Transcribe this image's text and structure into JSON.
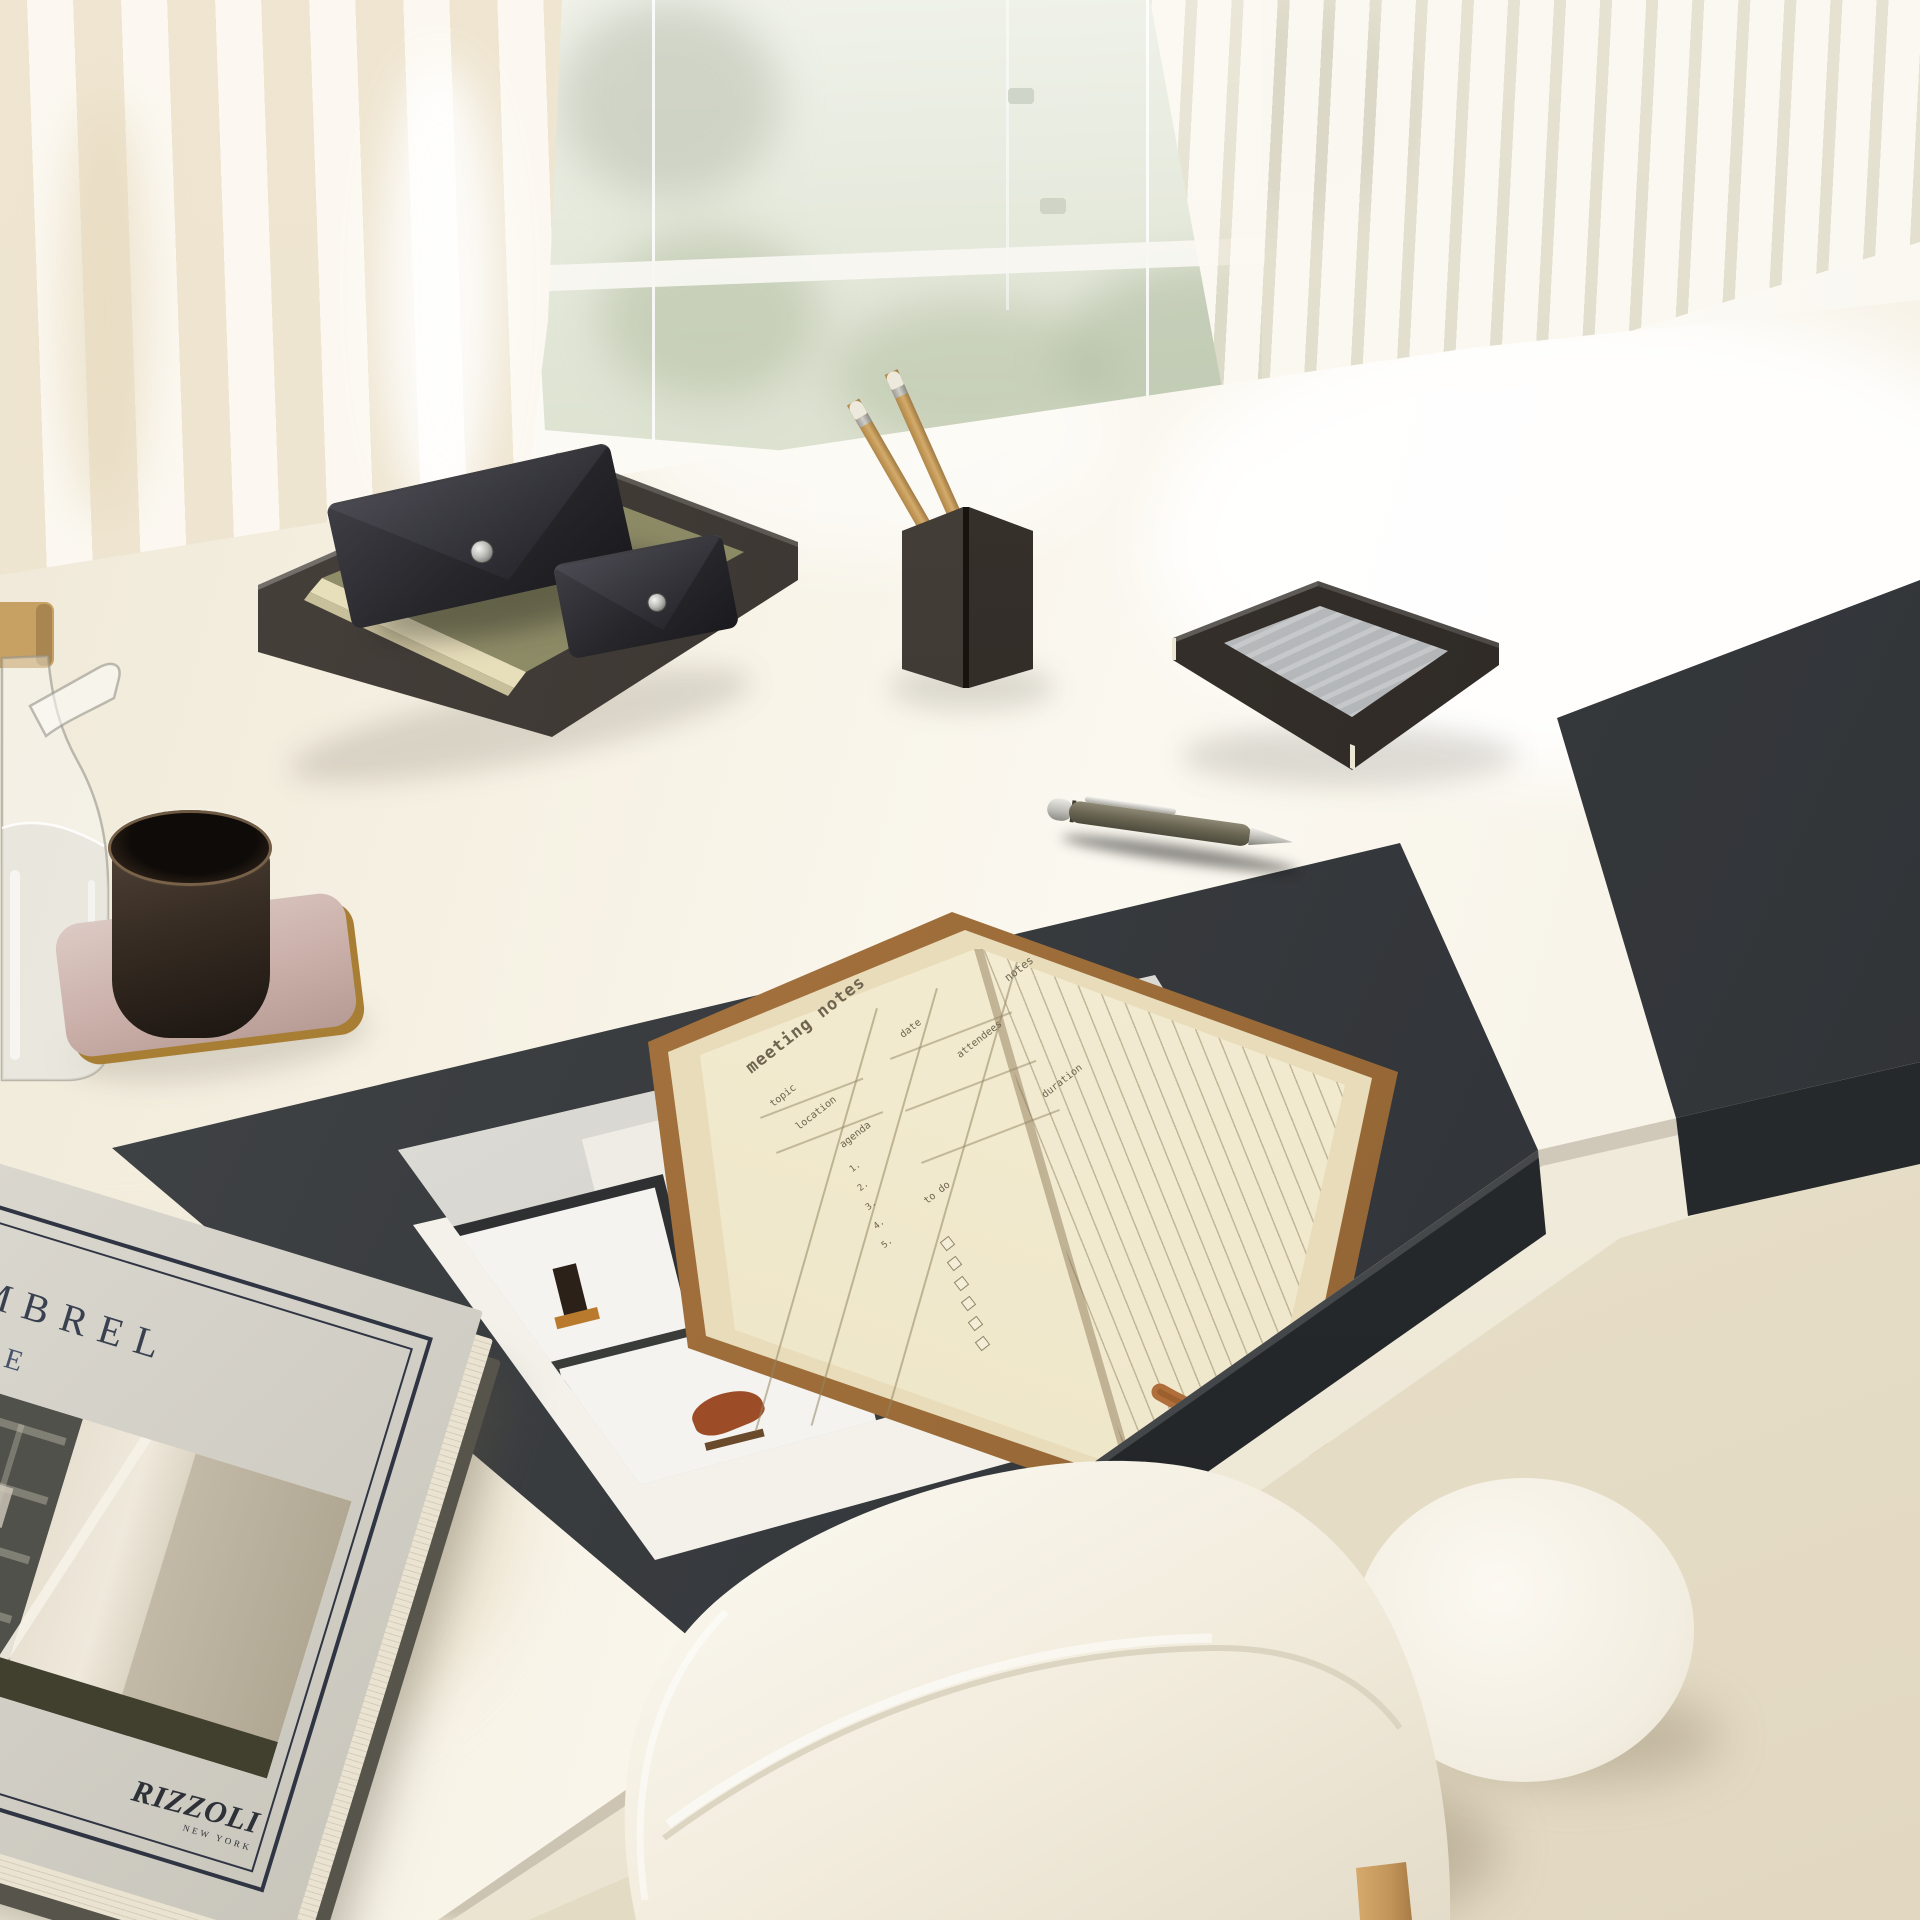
{
  "scene": {
    "setting": "bright minimalist home-office desk in front of a glass wall with sheer curtain and vertical blinds",
    "objects": [
      "sheer curtain",
      "glass wall with garden view",
      "vertical blinds",
      "white gloss desk",
      "charcoal leather desk pad",
      "charcoal accessory mat",
      "metal letter tray",
      "two leather snap pouches",
      "olive notebook in tray",
      "folded-metal pencil cup",
      "wooden pencils",
      "folded-metal paper tray with grey note paper",
      "glass water carafe with wooden lid",
      "dark ceramic cup",
      "mauve tray with brass edge",
      "olive ballpoint pen",
      "open planner notebook with leather bookmarks",
      "framed-art photo print",
      "grey coffee-table book",
      "white shell chair with wood legs",
      "round white side table"
    ]
  },
  "book": {
    "title_fragment_line1": "MBREL",
    "title_fragment_line2": "IVE",
    "publisher": "RIZZOLI",
    "publisher_city": "NEW YORK"
  },
  "notebook": {
    "left_page_title": "meeting notes",
    "labels": {
      "topic": "topic",
      "location": "location",
      "date": "date",
      "attendees": "attendees",
      "duration": "duration",
      "agenda": "agenda",
      "todo": "to do",
      "notes": "notes"
    },
    "agenda_items": [
      "1.",
      "2.",
      "3.",
      "4.",
      "5."
    ]
  },
  "colors": {
    "desk_pad": "#383b3e",
    "desk_surface": "#f6f1e3",
    "leather_pouch": "#232227",
    "olive_notebook": "#85835e",
    "cognac_cover": "#9c6c39",
    "page_cream": "#f2eace",
    "ribbon_tan": "#b06f3a",
    "pencil_wood": "#c9a05e",
    "mauve_tray": "#c9afa8",
    "brass_edge": "#a87e35",
    "floor_beige": "#e8e0cb",
    "grass_green": "#a0af85"
  }
}
